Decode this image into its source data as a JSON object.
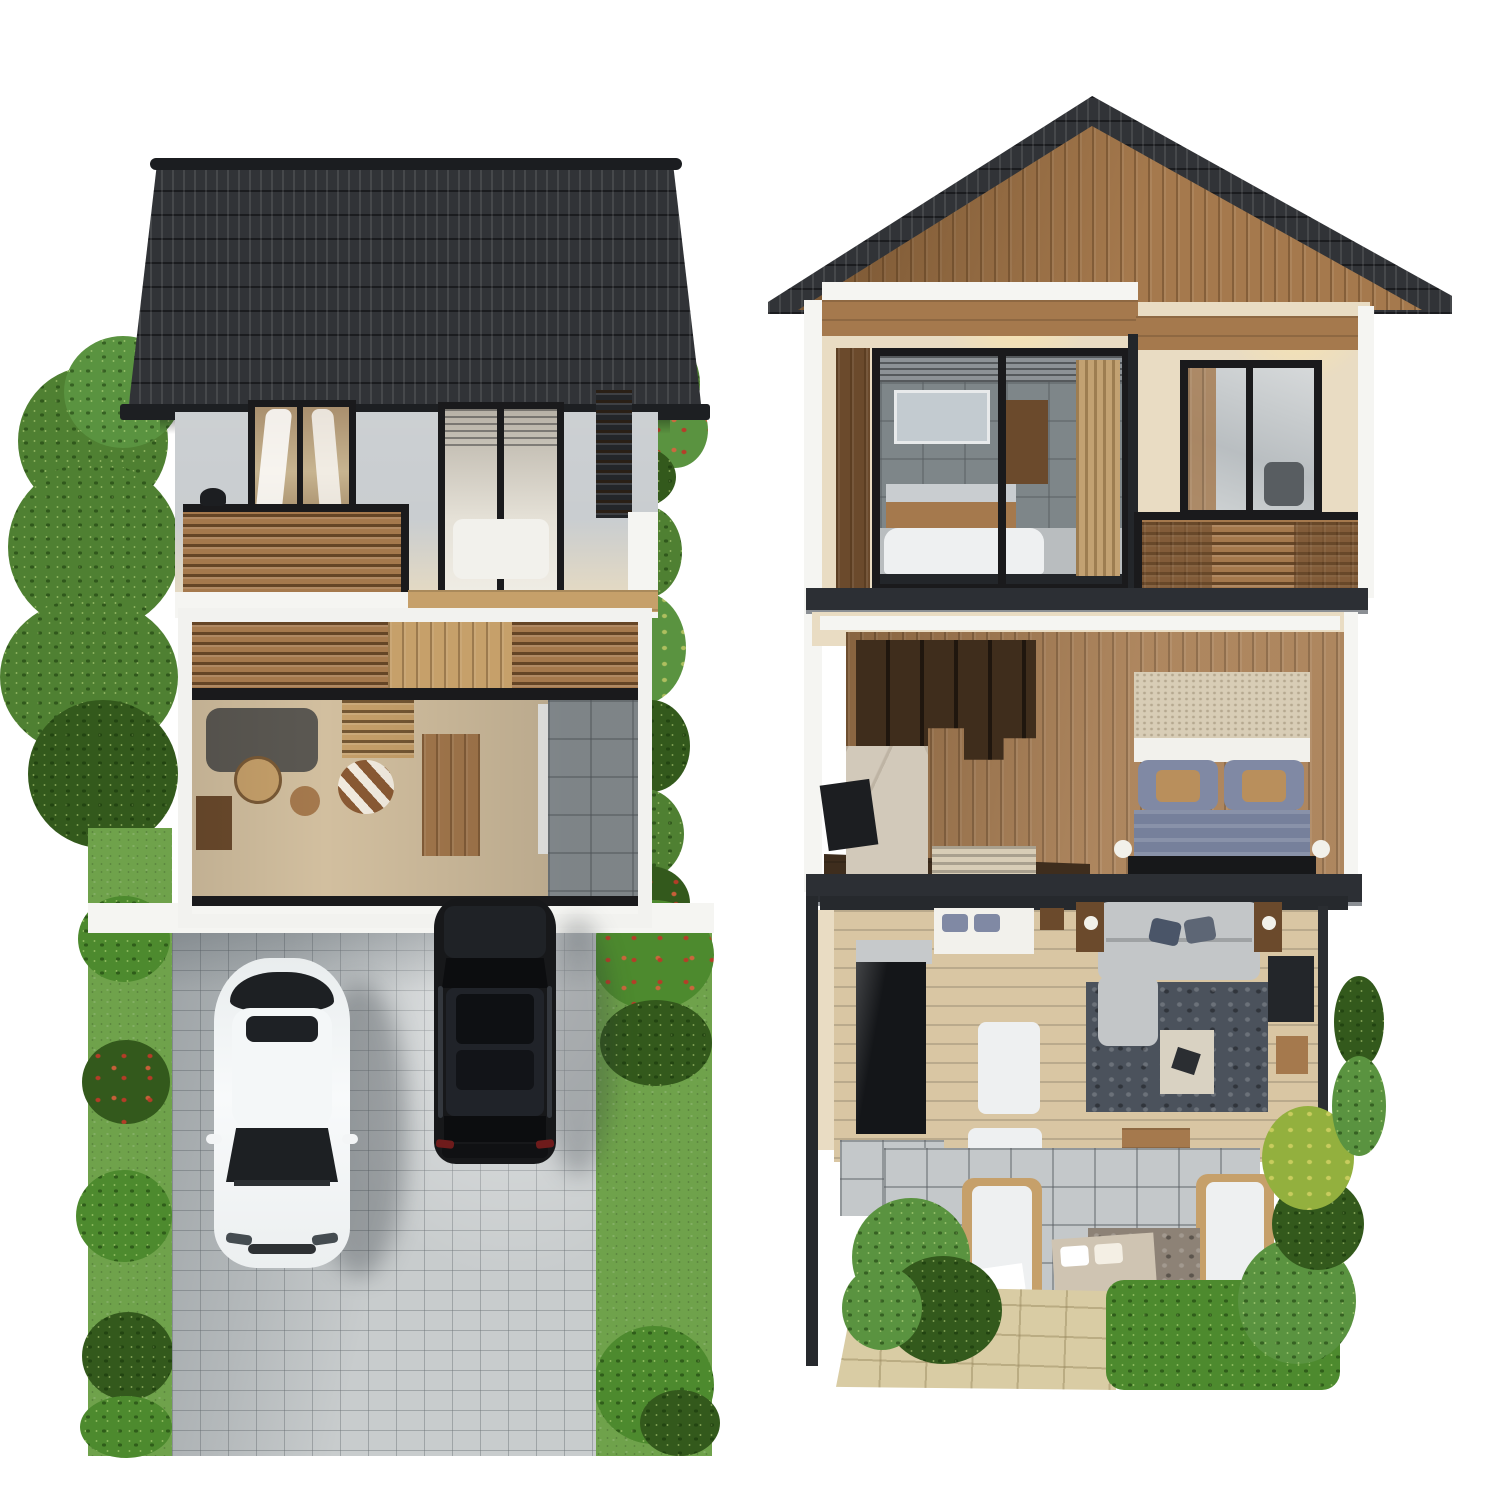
{
  "scene": {
    "background": "#ffffff",
    "views": {
      "left": {
        "name": "front-elevation-render",
        "features": [
          "gabled-tile-roof",
          "balcony",
          "cutaway-living-room",
          "paver-driveway",
          "two-parked-cars",
          "garden-trees"
        ]
      },
      "right": {
        "name": "cross-section-cutaway-render",
        "features": [
          "wood-gable-roof",
          "bathroom",
          "bedroom",
          "top-down-living-floor",
          "patio-garden"
        ]
      }
    }
  },
  "colors": {
    "background": "#ffffff",
    "roof_dark": "#26282c",
    "ridge_black": "#1b1d20",
    "gutter_black": "#1d1f22",
    "wall_gray": "#c9cdd0",
    "cream_wall": "#e9dcc3",
    "warm_glow": "#f6e7c3",
    "frame_black": "#1a1a1c",
    "wood": "#a5794d",
    "wood_dark": "#6b4a2c",
    "wood_deep": "#3f2d1c",
    "wood_light": "#c6a06a",
    "white_trim": "#f5f5f2",
    "slab": "#2c2f34",
    "slab_lip": "#8b8f94",
    "glass": "#c3c7c9",
    "glass_dark": "#7e8689",
    "interior_floor": "#d2bf9f",
    "tile_gray": "#8f969a",
    "paver": "#c8cccd",
    "grass": "#6fa24b",
    "foliage": "#4f8032",
    "foliage_dark": "#33591c",
    "plant": "#5a9340",
    "hedge": "#4d8a2e",
    "yellow_plant": "#93b03e",
    "sand": "#d9cca4",
    "patio_tile": "#c4c8ca",
    "wood_floor": "#d9c6a3",
    "sofa": "#c3c6c8",
    "rug": "#4b525c",
    "rug_warm": "#8d8276",
    "marble": "#d2c9ba",
    "kitchen_black": "#141619",
    "counter_gray": "#c6c9cb",
    "white_block": "#eef0f1",
    "chair_gray": "#b9bdc0",
    "table_cream": "#d9d2c2",
    "headboard": "#d8cdb6",
    "sheet_white": "#f2f1ec",
    "bed_blue": "#8089a4",
    "blanket_blue": "#76809b",
    "pillow_tan": "#b98f5c",
    "bed2": "#cfc4b2",
    "orange": "#c06a2e",
    "curtain": "#c2a172",
    "tv_black": "#1c1e21",
    "bench_black": "#17181a",
    "lamp_white": "#f2f1ea",
    "dark_wall": "#26292d",
    "dresser_tv": "#23262a",
    "blinds_gray": "#8d9296",
    "mirror_gray": "#c3cbd0",
    "tub_white": "#eef0f1",
    "fg_floor": "#3e2d1d"
  },
  "vehicles": {
    "white_sedan": {
      "body": "#f3f5f6",
      "roof": "#f4f7f8",
      "glass": "#1d2023",
      "sunroof": "#1e2125",
      "grille": "#2e3134",
      "headlight": "#454c51"
    },
    "black_suv": {
      "body": "#17181a",
      "hood": "#1f2226",
      "roof": "#202329",
      "glass": "#0c0d0f",
      "sunroof": "#0e1013",
      "rail": "#33373d",
      "taillight": "#6e1b1b",
      "bumper": "#101113"
    }
  }
}
